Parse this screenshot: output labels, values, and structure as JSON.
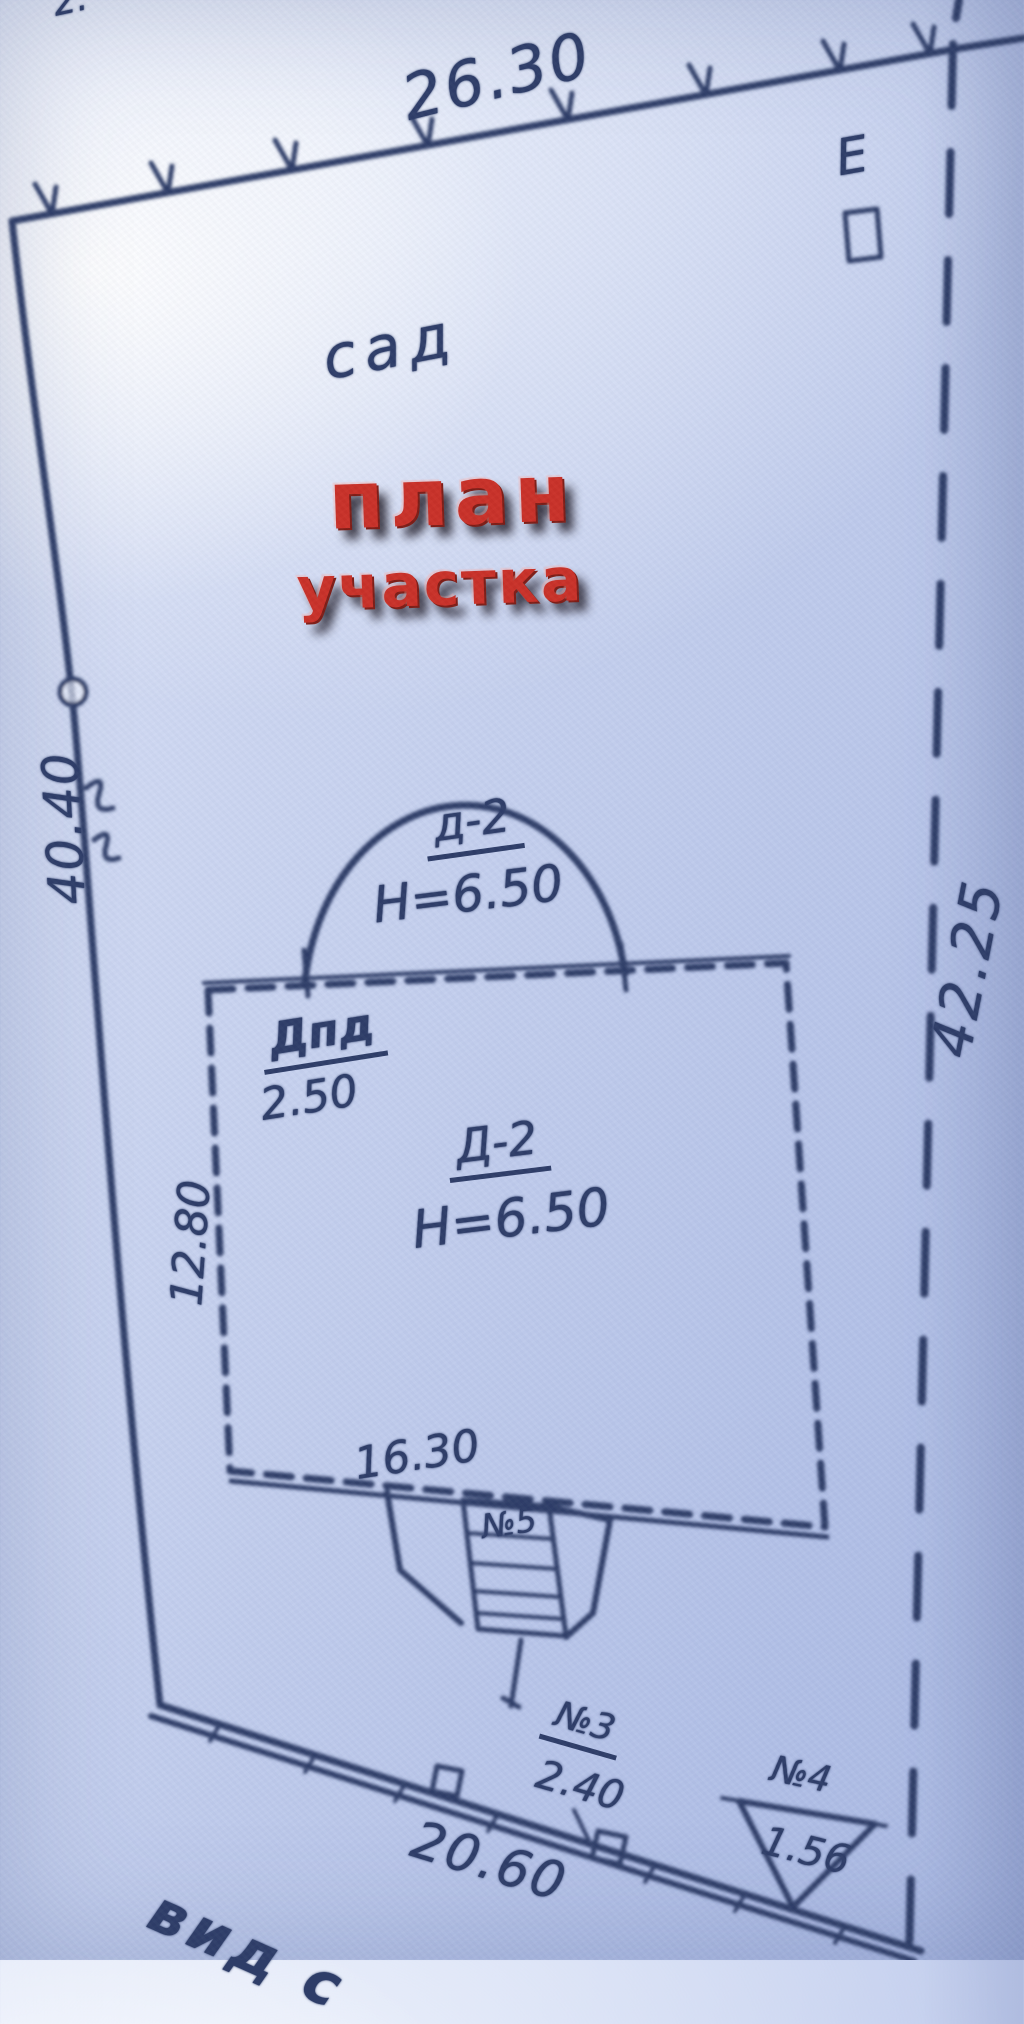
{
  "overlay": {
    "title_line1": "план",
    "title_line2": "участка"
  },
  "plan": {
    "garden_label": "сад",
    "corner_mark": "Е",
    "cut_top_text": "2.",
    "cut_bottom_text": "вид с"
  },
  "dims": {
    "top_boundary": "26.30",
    "left_boundary": "40.40",
    "right_boundary": "42.25",
    "bottom_boundary": "20.60",
    "house_width": "16.30",
    "house_depth": "12.80",
    "annex_width": "2.50",
    "shed3_size": "2.40",
    "shed4_size": "1.56"
  },
  "house": {
    "code": "Д-2",
    "height": "Н=6.50"
  },
  "veranda": {
    "code": "д-2",
    "height": "Н=6.50"
  },
  "marks": {
    "annex_code": "Дпд",
    "porch_code": "№5",
    "shed3_code": "№3",
    "shed4_code": "№4"
  },
  "colors": {
    "ink": "#2e3d68",
    "overlay_red": "#c93128",
    "paper": "#c7d2ef"
  }
}
